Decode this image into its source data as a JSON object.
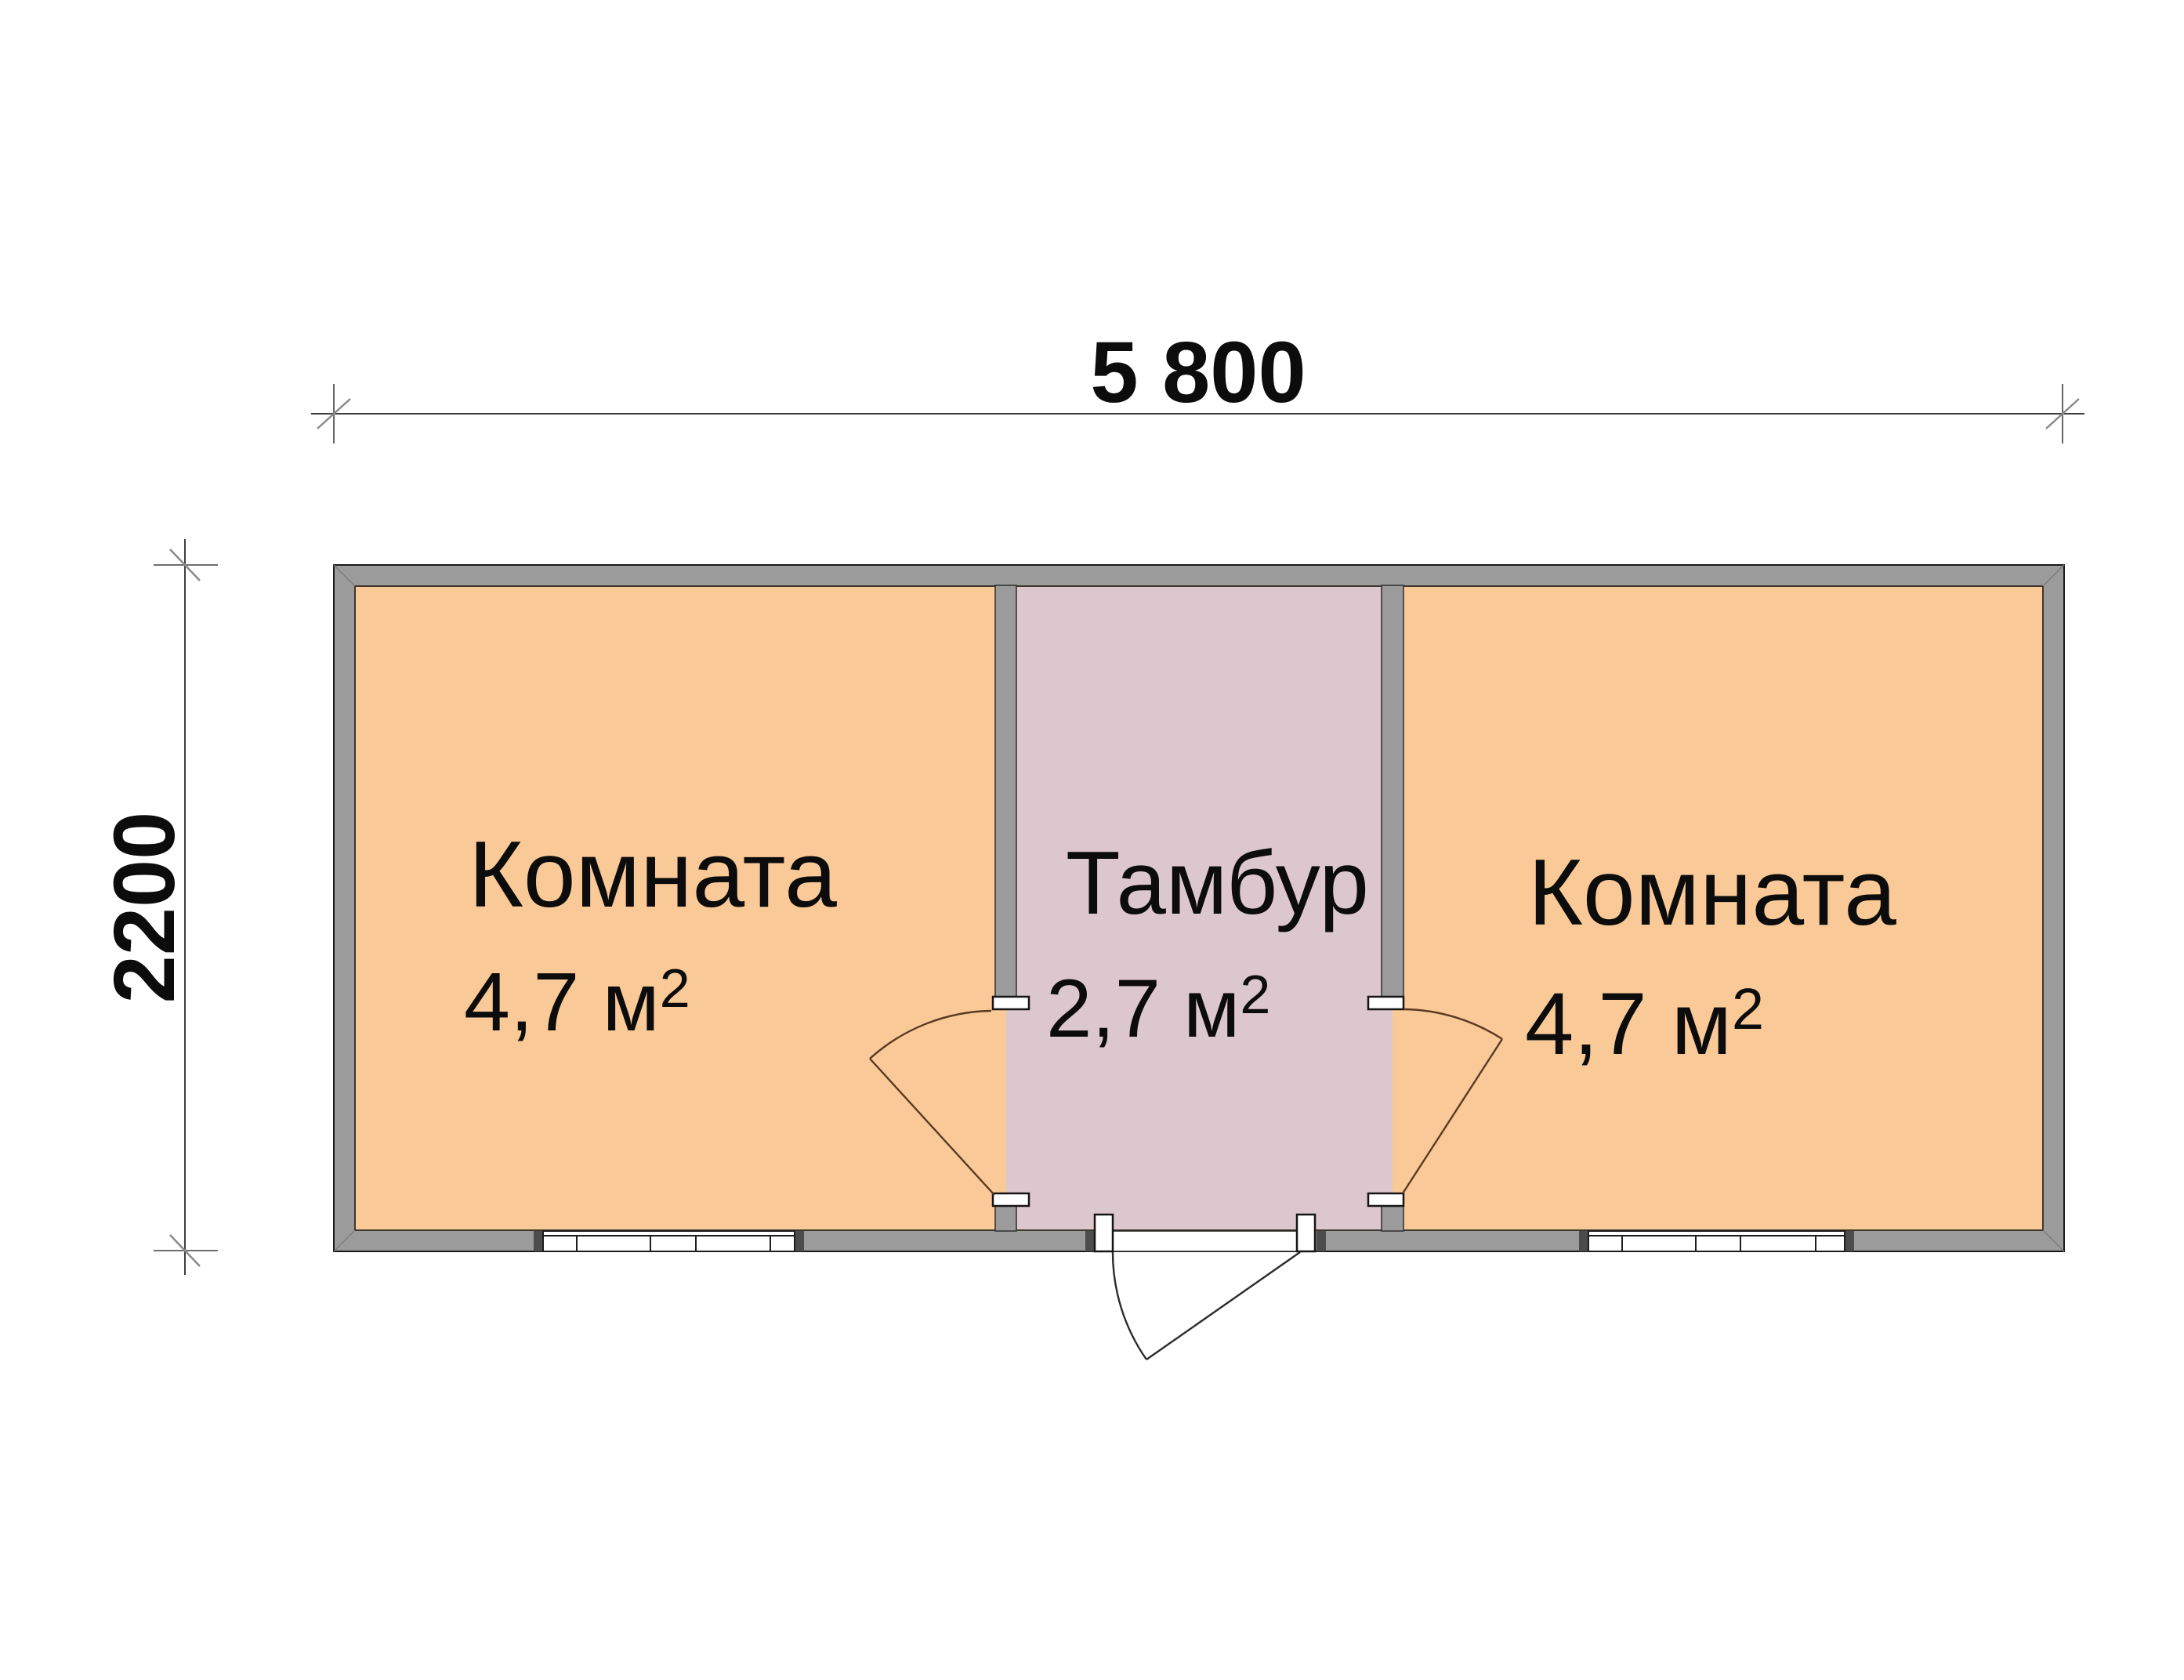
{
  "plan": {
    "rooms": [
      {
        "name": "Комната",
        "area_main": "4,7 м",
        "area_sup": "2"
      },
      {
        "name": "Тамбур",
        "area_main": "2,7 м",
        "area_sup": "2"
      },
      {
        "name": "Комната",
        "area_main": "4,7 м",
        "area_sup": "2"
      }
    ],
    "dimensions": {
      "width_label": "5 800",
      "height_label": "2200"
    }
  },
  "colors": {
    "room_fill": "#F9C997",
    "vestibule_fill": "#DBC7CD",
    "wall_fill": "#9B9B9B",
    "wall_outline": "#1a1a1a",
    "door_line": "#5B3A21",
    "dim_line": "#3F3F3F",
    "text": "#0C0C0C",
    "background": "#FFFFFF"
  }
}
